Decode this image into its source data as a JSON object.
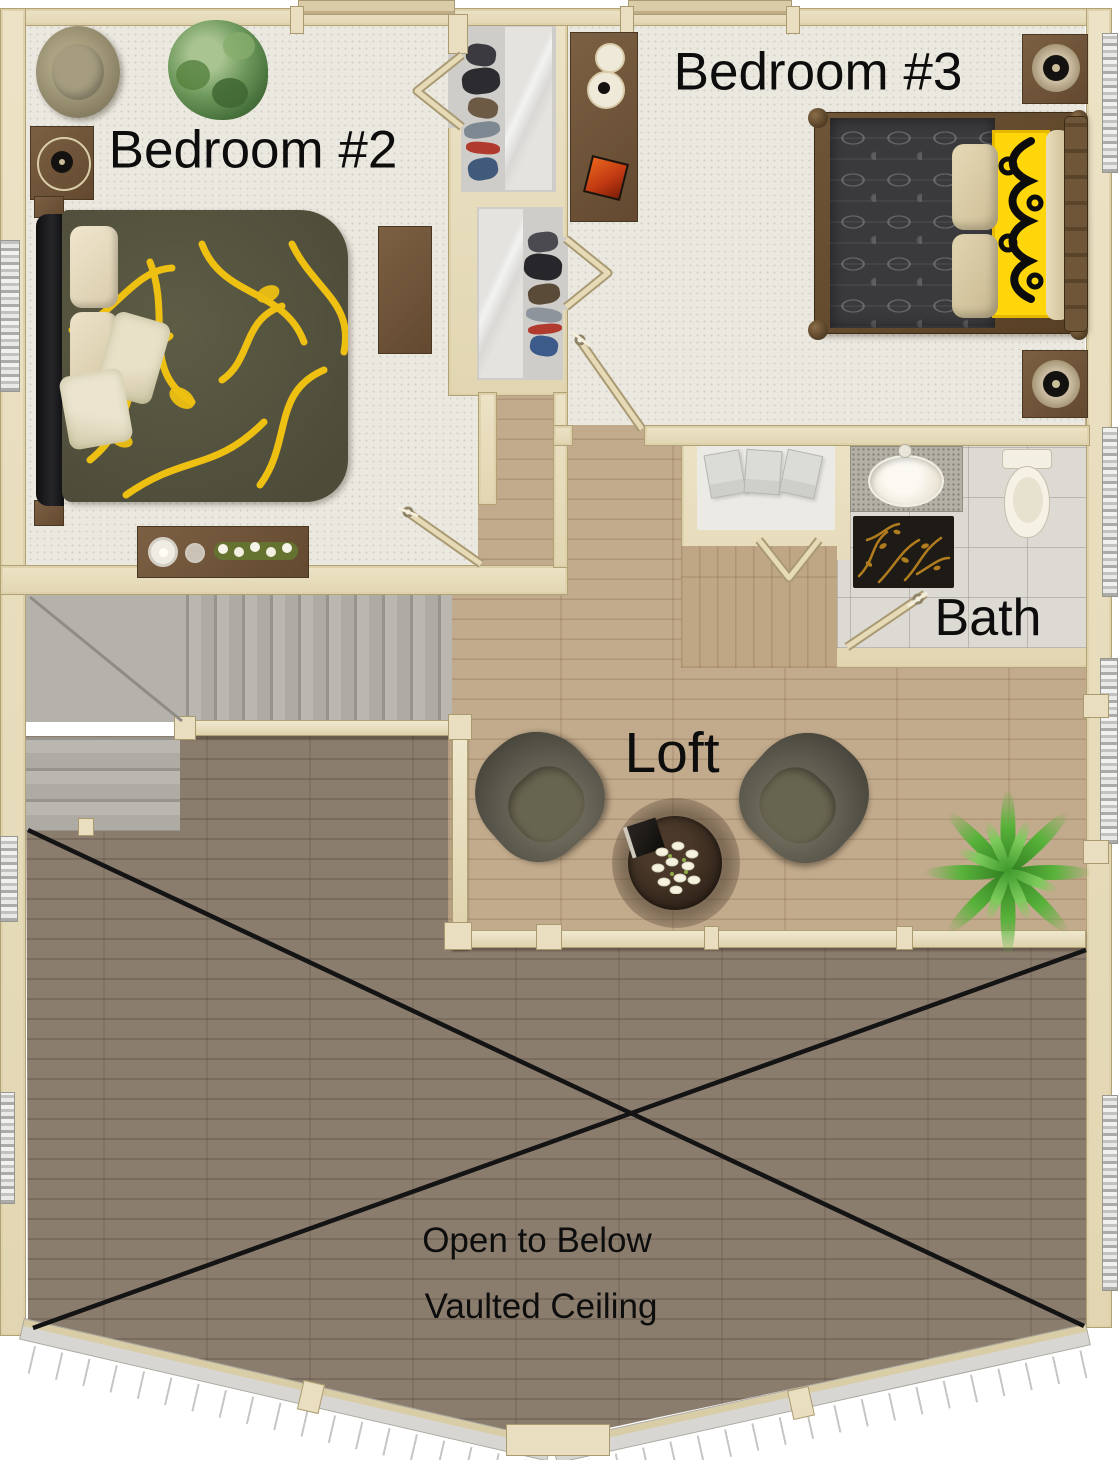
{
  "rooms": {
    "bedroom2": {
      "label": "Bedroom #2"
    },
    "bedroom3": {
      "label": "Bedroom #3"
    },
    "bath": {
      "label": "Bath"
    },
    "loft": {
      "label": "Loft"
    },
    "open_to_below": {
      "label": "Open to Below",
      "sublabel": "Vaulted Ceiling"
    }
  },
  "furniture": {
    "bedroom2": [
      "round-lounge-chair",
      "potted-plant",
      "nightstand-speaker",
      "double-bed-yellow-floral",
      "dresser-with-candles",
      "desk",
      "closet-with-clothes"
    ],
    "bedroom3": [
      "dresser-with-speakers",
      "double-bed-damask-yellow-runner",
      "nightstand-speaker",
      "nightstand-speaker",
      "closet-with-clothes"
    ],
    "bath": [
      "vanity-sink",
      "toilet",
      "black-gold-rug",
      "linen-closet-towels"
    ],
    "loft": [
      "armchair",
      "armchair",
      "round-coffee-table",
      "flower-vase",
      "palm-plant",
      "stair-railing"
    ],
    "stairs": [
      "u-shaped-staircase"
    ]
  },
  "colors": {
    "wall_cream": "#e8dfc1",
    "wall_edge": "#b3a176",
    "carpet": "#ebe8e0",
    "bath_tile": "#dcdad3",
    "loft_wood": "#c2aa8c",
    "lower_wood": "#8b7d6d",
    "stairs_gray": "#b5b2ac",
    "bed2_olive": "#565540",
    "accent_yellow": "#eec012",
    "bed3_charcoal": "#3a3a3c",
    "runner_yellow": "#ffd60a",
    "label_text": "#0d0d0d",
    "floor_line_black": "#141414"
  }
}
